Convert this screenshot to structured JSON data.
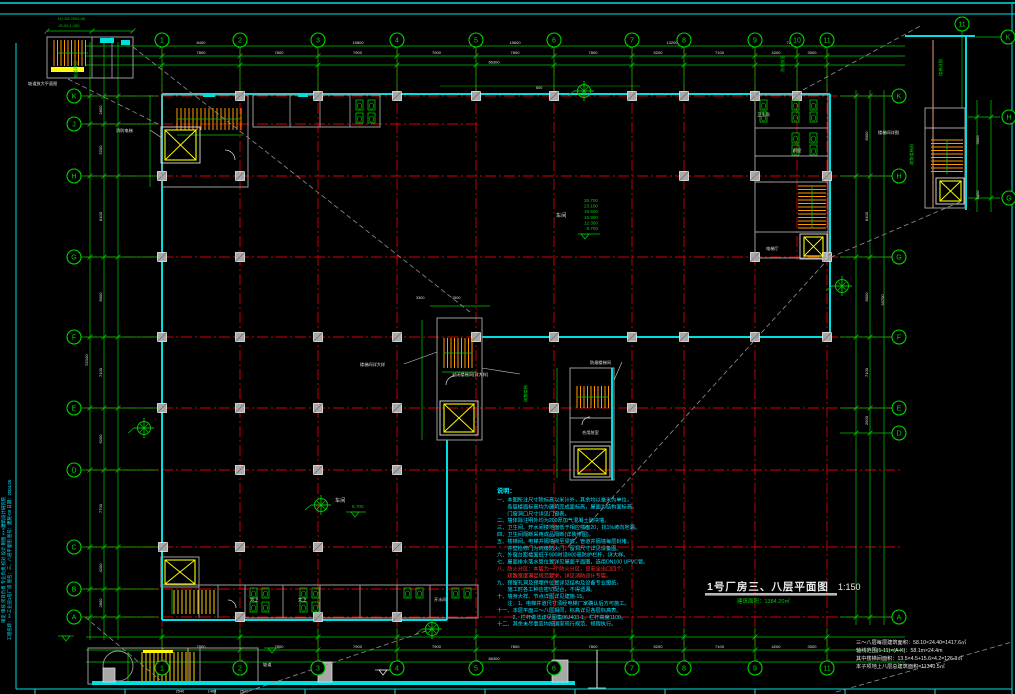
{
  "document": {
    "type": "CAD architectural floor plan",
    "background": "#000000"
  },
  "title_block": {
    "title": "1号厂房三、八层平面图",
    "scale": "1:150",
    "area_note": "建筑面积：1384.20㎡"
  },
  "colors": {
    "grid_red": "#d40000",
    "dim_green": "#00c800",
    "wall_cyan": "#00e0e0",
    "stair_orange": "#ff9900",
    "lift_yellow": "#ffff00",
    "part_gray": "#9c9c9c",
    "text_white": "#e0e0e0",
    "note_cyan": "#00e5ff",
    "note_red": "#ff3232",
    "salmon": "#e8a080"
  },
  "grid": {
    "cols": [
      {
        "label": "1",
        "x": 162,
        "bottom": true
      },
      {
        "label": "2",
        "x": 240,
        "bottom": true
      },
      {
        "label": "3",
        "x": 318,
        "bottom": true
      },
      {
        "label": "4",
        "x": 397,
        "bottom": true
      },
      {
        "label": "5",
        "x": 476,
        "bottom": true
      },
      {
        "label": "6",
        "x": 554,
        "bottom": true
      },
      {
        "label": "7",
        "x": 632,
        "bottom": true
      },
      {
        "label": "8",
        "x": 684,
        "bottom": true
      },
      {
        "label": "9",
        "x": 755,
        "bottom": true
      },
      {
        "label": "10",
        "x": 797,
        "bottom": false
      },
      {
        "label": "11",
        "x": 827,
        "bottom": true
      }
    ],
    "rows": [
      {
        "label": "K",
        "y": 96
      },
      {
        "label": "J",
        "y": 124
      },
      {
        "label": "H",
        "y": 176
      },
      {
        "label": "G",
        "y": 257
      },
      {
        "label": "F",
        "y": 337
      },
      {
        "label": "E",
        "y": 408
      },
      {
        "label": "D",
        "y": 470
      },
      {
        "label": "C",
        "y": 547
      },
      {
        "label": "B",
        "y": 589
      },
      {
        "label": "A",
        "y": 617
      }
    ],
    "rows_right": [
      {
        "label": "K",
        "y": 96
      },
      {
        "label": "H",
        "y": 176
      },
      {
        "label": "G",
        "y": 257
      },
      {
        "label": "F",
        "y": 337
      },
      {
        "label": "E",
        "y": 408
      },
      {
        "label": "D",
        "y": 433
      },
      {
        "label": "A",
        "y": 617
      }
    ],
    "detail_bubbles": [
      {
        "label": "11",
        "x": 962,
        "y": 24
      },
      {
        "label": "K",
        "x": 1008,
        "y": 37
      },
      {
        "label": "H",
        "x": 1009,
        "y": 117
      },
      {
        "label": "G",
        "x": 1009,
        "y": 198
      }
    ]
  },
  "dimensions": {
    "top_spans": [
      "7800",
      "7800",
      "7900",
      "7900",
      "7800",
      "7800",
      "5200",
      "7100",
      "4200",
      "3000"
    ],
    "top_groups": [
      {
        "v": "8400",
        "x": 201
      },
      {
        "v": "15800",
        "x": 358
      },
      {
        "v": "15600",
        "x": 515
      },
      {
        "v": "13200",
        "x": 672
      },
      {
        "v": "7200",
        "x": 791
      }
    ],
    "top_overall": "66300",
    "bottom_spans": [
      "7800",
      "7800",
      "7900",
      "7900",
      "7800",
      "7800",
      "5200",
      "7100",
      "4200",
      "3000"
    ],
    "bottom_overall": "66300",
    "bottom_sub": [
      {
        "v": "2540",
        "x": 180
      },
      {
        "v": "1460",
        "x": 212
      },
      {
        "v": "2540",
        "x": 244
      }
    ],
    "left_spans": [
      "2800",
      "5200",
      "8100",
      "8000",
      "7100",
      "6200",
      "7700",
      "4200",
      "2800"
    ],
    "left_overall": "52100",
    "right_spans": [
      "8000",
      "8100",
      "8000",
      "7100",
      "2500"
    ],
    "right_overall": "33700",
    "detail_right_spans": [
      "3600",
      "5400"
    ]
  },
  "elevations": {
    "main": {
      "values": [
        "26.700",
        "23.100",
        "19.500",
        "15.900",
        "12.300",
        "8.700"
      ]
    },
    "secondary": {
      "values": [
        "8.700"
      ]
    }
  },
  "notes": {
    "heading": "说明：",
    "lines": [
      {
        "text": "一、本图所注尺寸除标高以米计外，其余均以毫米为单位，",
        "red": false
      },
      {
        "text": "　　各层楼面标高均为建筑完成面标高，屋面为结构面标高，",
        "red": false
      },
      {
        "text": "　　门窗洞口尺寸详见门窗表。",
        "red": false
      },
      {
        "text": "二、墙体除注明外均为200厚加气混凝土砌块墙。",
        "red": false
      },
      {
        "text": "三、卫生间、开水间楼地面低于相应楼面20，找1%坡向地漏。",
        "red": false
      },
      {
        "text": "四、卫生间隔断采用成品隔断(详装修图)。",
        "red": false
      },
      {
        "text": "五、楼梯间、电梯井隔墙砌至梁底，管道井隔墙每层封堵，",
        "red": false
      },
      {
        "text": "　　井壁检修门为丙级防火门，留洞尺寸详见设备图。",
        "red": false
      },
      {
        "text": "六、外窗台距楼面低于900时设900高防护栏杆，详大样。",
        "red": false
      },
      {
        "text": "七、屋面排水落水管位置详见屋面平面图，选用DN100 UPVC管。",
        "red": false
      },
      {
        "text": "八、防火分区：本层为一个防火分区，设安全出口四个，",
        "red": true
      },
      {
        "text": "　　疏散宽度满足规范要求，详见消防设计专篇。",
        "red": true
      },
      {
        "text": "九、预留孔洞及预埋件位置详见结构及设备专业图纸，",
        "red": false
      },
      {
        "text": "　　施工时各工种应密切配合，不得遗漏。",
        "red": false
      },
      {
        "text": "十、墙身大样、节点详图详见建施-15。",
        "red": false
      },
      {
        "text": "　　注：1、电梯井道尺寸须经电梯厂家确认后方可施工。",
        "red": false
      },
      {
        "text": "十一、本层平面三～八层相同，标高详见各层标高表。",
        "red": false
      },
      {
        "text": "　　　2、栏杆做法详见图集06J403-1，栏杆高度1100。",
        "red": false
      },
      {
        "text": "十二、其余未尽事宜均按国家现行规范、规程执行。",
        "red": false
      }
    ]
  },
  "area_summary": [
    "三～八层每层建筑面积：58.10×24.40=1417.6㎡",
    "轴线范围(1-11)×(A-K)：58.1m×24.4m",
    "其中楼梯间面积：13.5×4.5+15.6×4.2=126.3㎡",
    "本子项地上八层总建筑面积=11340.5㎡"
  ],
  "labels": [
    {
      "t": "坡道放大平面图",
      "x": 28,
      "y": 85,
      "s": 4.2,
      "c": "#e0e0e0",
      "rot": 0
    },
    {
      "t": "消防电梯",
      "x": 116,
      "y": 132,
      "s": 4.2,
      "c": "#e0e0e0",
      "rot": 0
    },
    {
      "t": "楼梯间详大样",
      "x": 360,
      "y": 366,
      "s": 4.2,
      "c": "#e0e0e0",
      "rot": 0
    },
    {
      "t": "封闭楼梯间(详大样)",
      "x": 452,
      "y": 376,
      "s": 4.2,
      "c": "#e0e0e0",
      "rot": 0
    },
    {
      "t": "防烟楼梯间",
      "x": 590,
      "y": 364,
      "s": 4.2,
      "c": "#e0e0e0",
      "rot": 0
    },
    {
      "t": "合用前室",
      "x": 582,
      "y": 434,
      "s": 4.2,
      "c": "#e0e0e0",
      "rot": 0
    },
    {
      "t": "电梯厅",
      "x": 766,
      "y": 250,
      "s": 4.2,
      "c": "#e0e0e0",
      "rot": 0
    },
    {
      "t": "前室",
      "x": 793,
      "y": 152,
      "s": 4.2,
      "c": "#e0e0e0",
      "rot": 0
    },
    {
      "t": "卫生间",
      "x": 757,
      "y": 116,
      "s": 4.2,
      "c": "#e0e0e0",
      "rot": 0
    },
    {
      "t": "男卫",
      "x": 250,
      "y": 601,
      "s": 4.2,
      "c": "#e0e0e0",
      "rot": 0
    },
    {
      "t": "女卫",
      "x": 298,
      "y": 601,
      "s": 4.2,
      "c": "#e0e0e0",
      "rot": 0
    },
    {
      "t": "开水间",
      "x": 434,
      "y": 601,
      "s": 4.2,
      "c": "#e0e0e0",
      "rot": 0
    },
    {
      "t": "坡道",
      "x": 263,
      "y": 666,
      "s": 4.2,
      "c": "#e0e0e0",
      "rot": 0
    },
    {
      "t": "楼梯间详图",
      "x": 878,
      "y": 134,
      "s": 4.2,
      "c": "#e0e0e0",
      "rot": 0
    },
    {
      "t": "车间",
      "x": 556,
      "y": 217,
      "s": 5.2,
      "c": "#e0e0e0",
      "rot": 0
    },
    {
      "t": "车间",
      "x": 335,
      "y": 502,
      "s": 5.2,
      "c": "#e0e0e0",
      "rot": 0
    },
    {
      "t": "600",
      "x": 536,
      "y": 89,
      "s": 3.8,
      "c": "#e0e0e0",
      "rot": 0
    },
    {
      "t": "3300",
      "x": 416,
      "y": 299,
      "s": 3.8,
      "c": "#e0e0e0",
      "rot": 0
    },
    {
      "t": "1500",
      "x": 452,
      "y": 299,
      "s": 3.8,
      "c": "#e0e0e0",
      "rot": 0
    },
    {
      "t": "坡道详图",
      "x": 77,
      "y": 78,
      "s": 4.2,
      "c": "#00c800",
      "rot": -90
    },
    {
      "t": "防烟前室",
      "x": 784,
      "y": 72,
      "s": 4.2,
      "c": "#00c800",
      "rot": -90
    },
    {
      "t": "疏散楼梯间",
      "x": 913,
      "y": 165,
      "s": 4.2,
      "c": "#00c800",
      "rot": -90
    },
    {
      "t": "楼梯详图",
      "x": 942,
      "y": 76,
      "s": 4.2,
      "c": "#00c800",
      "rot": -90
    },
    {
      "t": "疏散楼梯",
      "x": 527,
      "y": 402,
      "s": 4.2,
      "c": "#00c800",
      "rot": -90
    }
  ],
  "corner_text": [
    "N7-D8 2004.06",
    "JS-09 1:150"
  ],
  "margin_text": [
    {
      "text": "审定  审核  项目负责  专业负责  校对  设计  制图  ×××建筑设计研究院",
      "x": 5
    },
    {
      "text": "工程名称：××工业园1号厂房  图名：三、八层平面图  图号：建施-09  日期：2004.06",
      "x": 11
    }
  ],
  "symbols": {
    "axis_marker_positions": [
      [
        584,
        91
      ],
      [
        842,
        286
      ],
      [
        144,
        428
      ],
      [
        432,
        629
      ],
      [
        321,
        505
      ]
    ]
  }
}
